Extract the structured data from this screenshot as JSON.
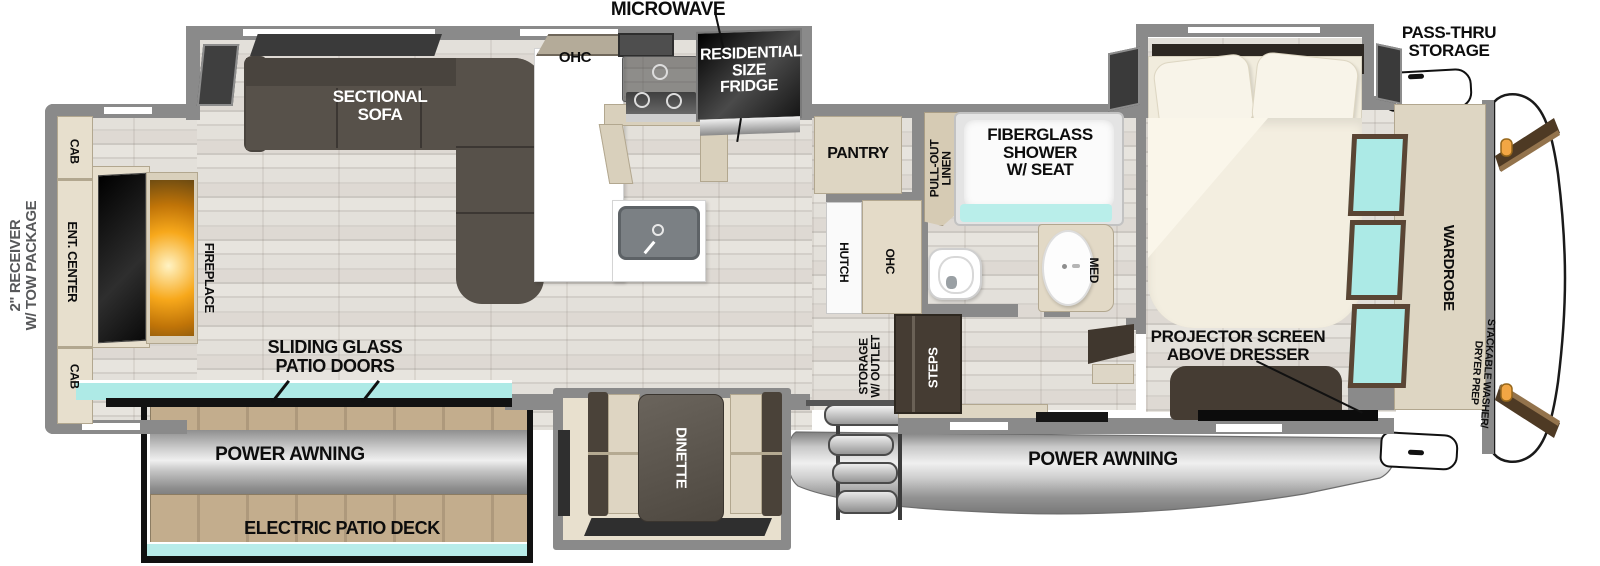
{
  "title": "RV fifth-wheel floor plan",
  "colors": {
    "wall": "#8a8a8a",
    "cabinet_tan": "#ded6c3",
    "furniture_dark": "#453c33",
    "sofa": "#57514a",
    "glass_teal": "#aceae6",
    "fireplace_orange": "#f7a81b",
    "marker_light_orange": "#f2a644",
    "awning_silver": "#cdcdcd",
    "deck_wood": "#c3ad8d",
    "label_black": "#0d0d0d",
    "label_gray": "#57585a"
  },
  "labels": {
    "microwave": "MICROWAVE",
    "pass_thru": [
      "PASS-THRU",
      "STORAGE"
    ],
    "fridge": [
      "RESIDENTIAL",
      "SIZE",
      "FRIDGE"
    ],
    "ohc_kitchen": "OHC",
    "sectional": [
      "SECTIONAL",
      "SOFA"
    ],
    "cab_top": "CAB",
    "cab_bottom": "CAB",
    "ent_center": "ENT. CENTER",
    "fireplace": "FIREPLACE",
    "receiver": [
      "2\" RECEIVER",
      "W/ TOW PACKAGE"
    ],
    "sliding_doors": [
      "SLIDING GLASS",
      "PATIO DOORS"
    ],
    "power_awning_left": "POWER AWNING",
    "electric_patio_deck": "ELECTRIC PATIO DECK",
    "dinette": "DINETTE",
    "pantry": "PANTRY",
    "pull_out": [
      "PULL-OUT",
      "LINEN"
    ],
    "shower": [
      "FIBERGLASS",
      "SHOWER",
      "W/ SEAT"
    ],
    "hutch": "HUTCH",
    "ohc_bath": "OHC",
    "med": "MED",
    "storage_outlet": [
      "STORAGE",
      "W/ OUTLET"
    ],
    "steps": "STEPS",
    "wardrobe": "WARDROBE",
    "stackable": [
      "STACKABLE WASHER/",
      "DRYER PREP"
    ],
    "projector": [
      "PROJECTOR SCREEN",
      "ABOVE DRESSER"
    ],
    "power_awning_right": "POWER AWNING"
  }
}
